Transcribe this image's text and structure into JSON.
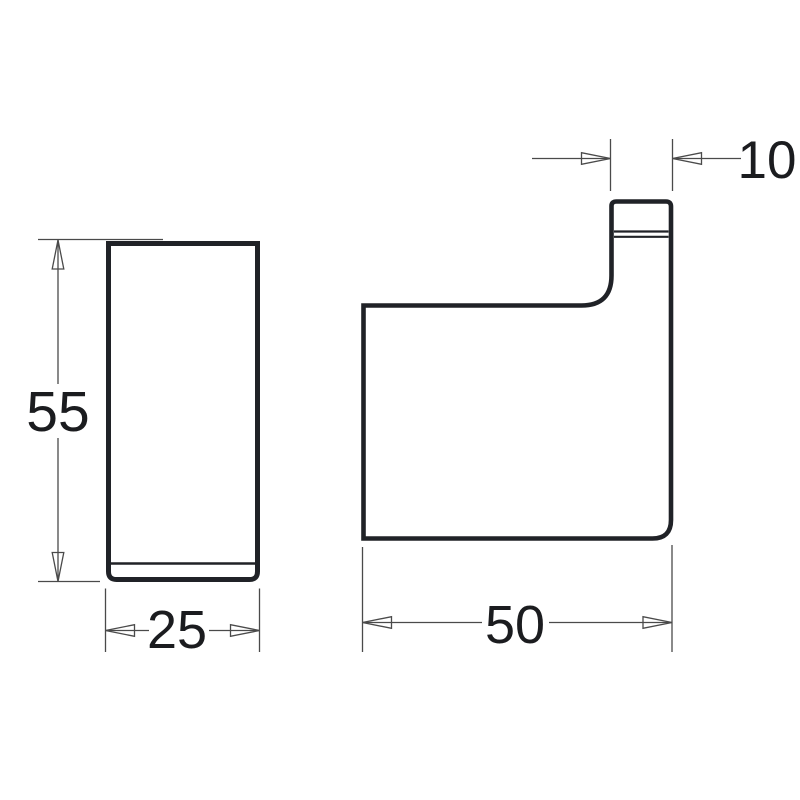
{
  "drawing": {
    "type": "technical-dimension-drawing",
    "views": {
      "front_view": "rectangular front elevation of hook",
      "side_view": "hook side profile with protruding tip"
    },
    "dimensions": {
      "front_height": "55",
      "front_width": "25",
      "side_depth": "50",
      "hook_tip_depth": "10"
    }
  },
  "colors": {
    "background": "#ffffff",
    "outline": "#202227",
    "dimension_lines": "#4a4a4a",
    "label_text": "#1b1c1f"
  }
}
